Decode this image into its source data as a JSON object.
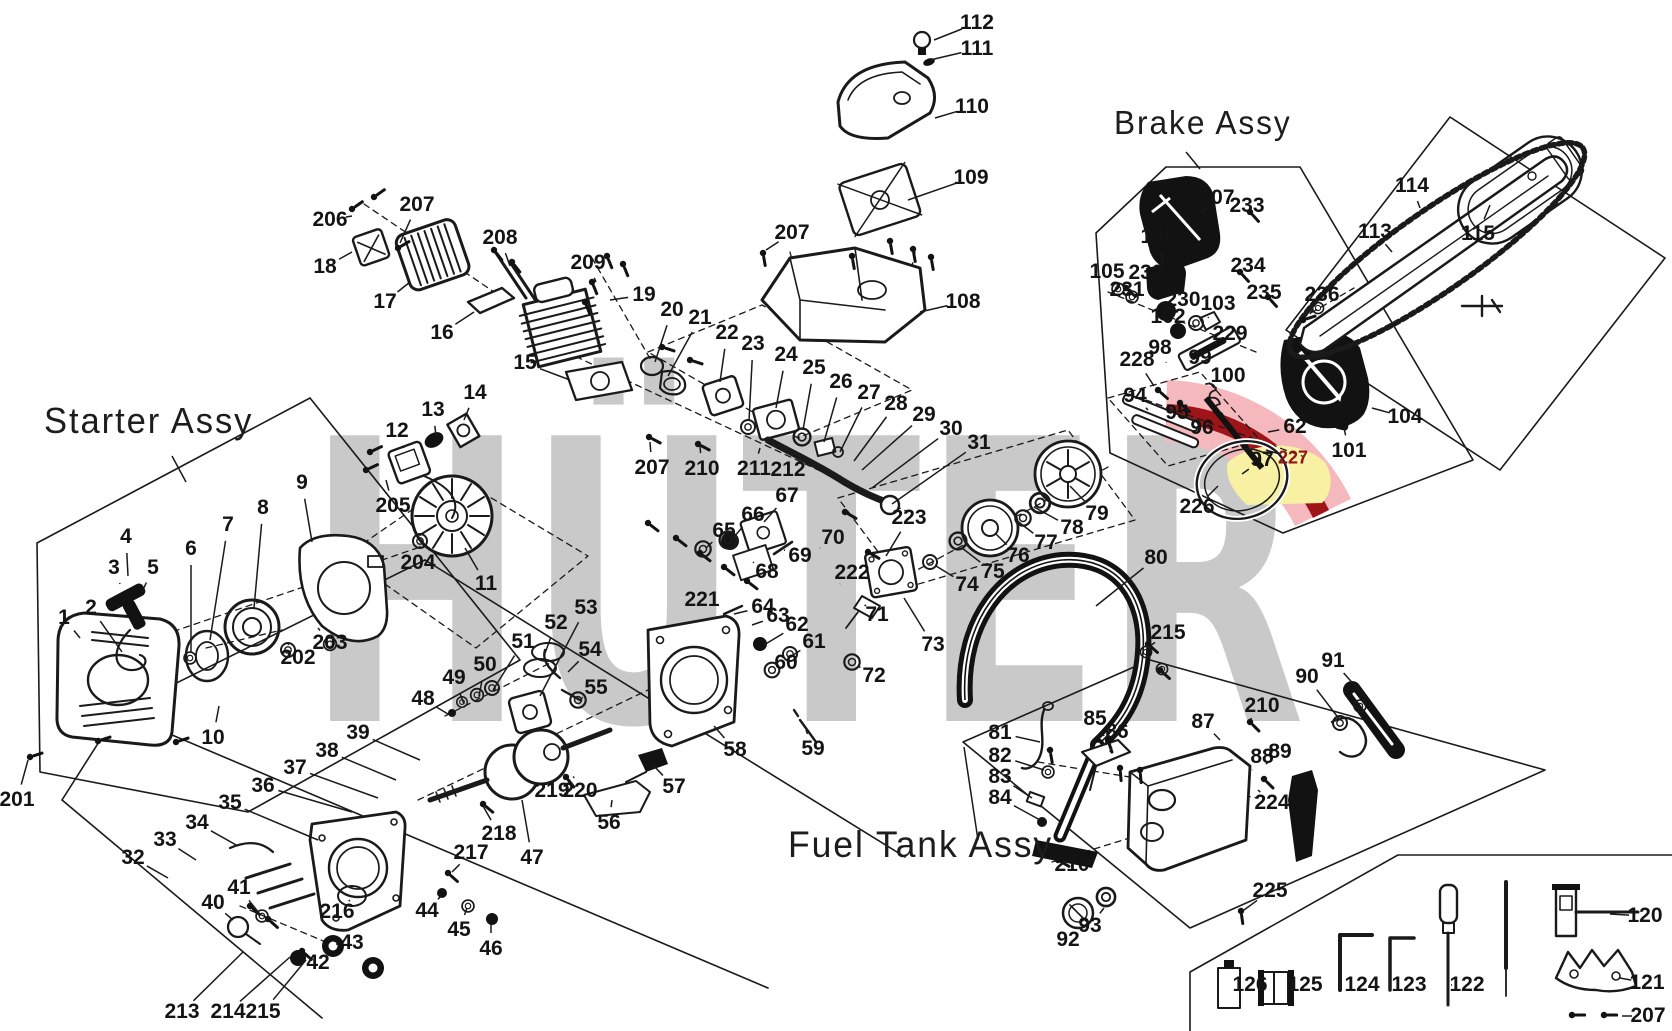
{
  "watermark": {
    "text": "HÜTER",
    "color": "#c9c9c9"
  },
  "emblem": {
    "pink": "#f5b9bd",
    "dark_red": "#9f1418",
    "yellow": "#f8f1a3"
  },
  "line_color": "#1a1a1a",
  "assemblies": [
    {
      "label": "Starter Assy",
      "x": 44,
      "y": 400,
      "size": 36,
      "leader": [
        172,
        456,
        186,
        482
      ]
    },
    {
      "label": "Brake Assy",
      "x": 1114,
      "y": 104,
      "size": 33,
      "leader": [
        1186,
        152,
        1200,
        169
      ]
    },
    {
      "label": "Fuel Tank Assy",
      "x": 788,
      "y": 824,
      "size": 37,
      "leader": [
        978,
        840,
        964,
        747
      ]
    }
  ],
  "parts": [
    {
      "n": "206",
      "x": 330,
      "y": 220,
      "t": [
        352,
        216
      ]
    },
    {
      "n": "207",
      "x": 417,
      "y": 205,
      "t": [
        400,
        243
      ]
    },
    {
      "n": "18",
      "x": 325,
      "y": 267,
      "t": [
        352,
        252
      ]
    },
    {
      "n": "17",
      "x": 385,
      "y": 302,
      "t": [
        410,
        282
      ]
    },
    {
      "n": "16",
      "x": 442,
      "y": 333,
      "t": [
        474,
        312
      ]
    },
    {
      "n": "208",
      "x": 500,
      "y": 238,
      "t": [
        510,
        266
      ]
    },
    {
      "n": "112",
      "x": 977,
      "y": 23,
      "t": [
        934,
        40
      ]
    },
    {
      "n": "111",
      "x": 977,
      "y": 49,
      "t": [
        930,
        60
      ]
    },
    {
      "n": "110",
      "x": 972,
      "y": 107,
      "t": [
        935,
        118
      ]
    },
    {
      "n": "109",
      "x": 971,
      "y": 178,
      "t": [
        908,
        200
      ]
    },
    {
      "n": "207",
      "x": 792,
      "y": 233,
      "t": [
        766,
        250
      ]
    },
    {
      "n": "108",
      "x": 963,
      "y": 302,
      "t": [
        920,
        312
      ]
    },
    {
      "n": "209",
      "x": 588,
      "y": 263,
      "t": [
        596,
        282
      ]
    },
    {
      "n": "19",
      "x": 644,
      "y": 295,
      "t": [
        610,
        300
      ]
    },
    {
      "n": "20",
      "x": 672,
      "y": 310,
      "t": [
        655,
        362
      ]
    },
    {
      "n": "21",
      "x": 700,
      "y": 318,
      "t": [
        668,
        376
      ]
    },
    {
      "n": "22",
      "x": 727,
      "y": 333,
      "t": [
        720,
        382
      ]
    },
    {
      "n": "23",
      "x": 753,
      "y": 344,
      "t": [
        749,
        421
      ]
    },
    {
      "n": "24",
      "x": 786,
      "y": 355,
      "t": [
        776,
        408
      ]
    },
    {
      "n": "25",
      "x": 814,
      "y": 368,
      "t": [
        803,
        430
      ]
    },
    {
      "n": "26",
      "x": 841,
      "y": 382,
      "t": [
        824,
        442
      ]
    },
    {
      "n": "27",
      "x": 869,
      "y": 393,
      "t": [
        840,
        452
      ]
    },
    {
      "n": "28",
      "x": 896,
      "y": 404,
      "t": [
        854,
        461
      ]
    },
    {
      "n": "29",
      "x": 924,
      "y": 415,
      "t": [
        862,
        470
      ]
    },
    {
      "n": "30",
      "x": 951,
      "y": 429,
      "t": [
        872,
        488
      ]
    },
    {
      "n": "31",
      "x": 979,
      "y": 443,
      "t": [
        892,
        504
      ]
    },
    {
      "n": "15",
      "x": 525,
      "y": 363,
      "t": [
        570,
        380
      ]
    },
    {
      "n": "207",
      "x": 652,
      "y": 468,
      "t": [
        650,
        442
      ]
    },
    {
      "n": "210",
      "x": 702,
      "y": 469,
      "t": [
        700,
        446
      ]
    },
    {
      "n": "211",
      "x": 754,
      "y": 469,
      "t": [
        760,
        448
      ]
    },
    {
      "n": "212",
      "x": 788,
      "y": 470,
      "t": [
        798,
        455
      ]
    },
    {
      "n": "1",
      "x": 64,
      "y": 618,
      "t": [
        80,
        638
      ]
    },
    {
      "n": "2",
      "x": 91,
      "y": 608,
      "t": [
        122,
        652
      ]
    },
    {
      "n": "3",
      "x": 114,
      "y": 568,
      "t": [
        120,
        584
      ]
    },
    {
      "n": "4",
      "x": 126,
      "y": 537,
      "t": [
        128,
        576
      ]
    },
    {
      "n": "5",
      "x": 153,
      "y": 568,
      "t": [
        142,
        592
      ]
    },
    {
      "n": "6",
      "x": 191,
      "y": 549,
      "t": [
        191,
        652
      ]
    },
    {
      "n": "7",
      "x": 228,
      "y": 525,
      "t": [
        210,
        640
      ]
    },
    {
      "n": "8",
      "x": 263,
      "y": 508,
      "t": [
        254,
        608
      ]
    },
    {
      "n": "9",
      "x": 302,
      "y": 483,
      "t": [
        312,
        542
      ]
    },
    {
      "n": "10",
      "x": 213,
      "y": 738,
      "t": [
        219,
        706
      ]
    },
    {
      "n": "201",
      "x": 17,
      "y": 800,
      "t": [
        28,
        760
      ]
    },
    {
      "n": "202",
      "x": 298,
      "y": 658,
      "t": [
        288,
        644
      ]
    },
    {
      "n": "203",
      "x": 330,
      "y": 643,
      "t": [
        318,
        628
      ]
    },
    {
      "n": "204",
      "x": 418,
      "y": 563,
      "t": [
        420,
        546
      ]
    },
    {
      "n": "205",
      "x": 393,
      "y": 506,
      "t": [
        386,
        480
      ]
    },
    {
      "n": "11",
      "x": 486,
      "y": 584,
      "t": [
        465,
        548
      ]
    },
    {
      "n": "12",
      "x": 397,
      "y": 431,
      "t": [
        404,
        448
      ]
    },
    {
      "n": "13",
      "x": 433,
      "y": 410,
      "t": [
        436,
        436
      ]
    },
    {
      "n": "14",
      "x": 475,
      "y": 393,
      "t": [
        464,
        420
      ]
    },
    {
      "n": "48",
      "x": 423,
      "y": 699,
      "t": [
        448,
        714
      ]
    },
    {
      "n": "49",
      "x": 454,
      "y": 678,
      "t": [
        464,
        704
      ]
    },
    {
      "n": "50",
      "x": 485,
      "y": 665,
      "t": [
        479,
        696
      ]
    },
    {
      "n": "51",
      "x": 523,
      "y": 642,
      "t": [
        493,
        690
      ]
    },
    {
      "n": "52",
      "x": 556,
      "y": 623,
      "t": [
        544,
        656
      ]
    },
    {
      "n": "53",
      "x": 586,
      "y": 608,
      "t": [
        540,
        696
      ]
    },
    {
      "n": "54",
      "x": 590,
      "y": 650,
      "t": [
        568,
        672
      ]
    },
    {
      "n": "55",
      "x": 596,
      "y": 688,
      "t": [
        582,
        698
      ]
    },
    {
      "n": "56",
      "x": 609,
      "y": 823,
      "t": [
        612,
        800
      ]
    },
    {
      "n": "57",
      "x": 674,
      "y": 787,
      "t": [
        652,
        764
      ]
    },
    {
      "n": "58",
      "x": 735,
      "y": 750,
      "t": [
        714,
        726
      ]
    },
    {
      "n": "59",
      "x": 813,
      "y": 749,
      "t": [
        806,
        730
      ]
    },
    {
      "n": "60",
      "x": 786,
      "y": 663,
      "t": [
        775,
        672
      ]
    },
    {
      "n": "61",
      "x": 814,
      "y": 642,
      "t": [
        793,
        655
      ]
    },
    {
      "n": "62",
      "x": 797,
      "y": 625,
      "t": [
        764,
        645
      ]
    },
    {
      "n": "63",
      "x": 778,
      "y": 616,
      "t": [
        752,
        625
      ]
    },
    {
      "n": "64",
      "x": 763,
      "y": 607,
      "t": [
        734,
        614
      ]
    },
    {
      "n": "65",
      "x": 724,
      "y": 531,
      "t": [
        706,
        548
      ]
    },
    {
      "n": "66",
      "x": 753,
      "y": 515,
      "t": [
        733,
        538
      ]
    },
    {
      "n": "67",
      "x": 787,
      "y": 496,
      "t": [
        764,
        522
      ]
    },
    {
      "n": "68",
      "x": 767,
      "y": 572,
      "t": [
        753,
        562
      ]
    },
    {
      "n": "69",
      "x": 800,
      "y": 556,
      "t": [
        784,
        550
      ]
    },
    {
      "n": "70",
      "x": 833,
      "y": 538,
      "t": [
        820,
        548
      ]
    },
    {
      "n": "71",
      "x": 877,
      "y": 615,
      "t": [
        866,
        606
      ]
    },
    {
      "n": "72",
      "x": 874,
      "y": 676,
      "t": [
        858,
        666
      ]
    },
    {
      "n": "221",
      "x": 702,
      "y": 600,
      "t": [
        716,
        592
      ]
    },
    {
      "n": "222",
      "x": 852,
      "y": 573,
      "t": [
        840,
        584
      ]
    },
    {
      "n": "223",
      "x": 909,
      "y": 518,
      "t": [
        886,
        556
      ]
    },
    {
      "n": "219",
      "x": 552,
      "y": 791,
      "t": [
        564,
        780
      ]
    },
    {
      "n": "220",
      "x": 580,
      "y": 791,
      "t": [
        574,
        778
      ]
    },
    {
      "n": "218",
      "x": 499,
      "y": 834,
      "t": [
        483,
        806
      ]
    },
    {
      "n": "217",
      "x": 471,
      "y": 853,
      "t": [
        452,
        872
      ]
    },
    {
      "n": "216",
      "x": 337,
      "y": 912,
      "t": [
        350,
        900
      ]
    },
    {
      "n": "47",
      "x": 532,
      "y": 858,
      "t": [
        522,
        800
      ]
    },
    {
      "n": "44",
      "x": 427,
      "y": 911,
      "t": [
        441,
        896
      ]
    },
    {
      "n": "45",
      "x": 459,
      "y": 930,
      "t": [
        467,
        908
      ]
    },
    {
      "n": "46",
      "x": 491,
      "y": 949,
      "t": [
        491,
        924
      ]
    },
    {
      "n": "43",
      "x": 352,
      "y": 943,
      "t": [
        338,
        944
      ]
    },
    {
      "n": "42",
      "x": 318,
      "y": 963,
      "t": [
        303,
        958
      ]
    },
    {
      "n": "40",
      "x": 213,
      "y": 903,
      "t": [
        233,
        920
      ]
    },
    {
      "n": "41",
      "x": 239,
      "y": 888,
      "t": [
        259,
        913
      ]
    },
    {
      "n": "32",
      "x": 133,
      "y": 858,
      "t": [
        168,
        878
      ]
    },
    {
      "n": "33",
      "x": 165,
      "y": 840,
      "t": [
        196,
        860
      ]
    },
    {
      "n": "34",
      "x": 197,
      "y": 823,
      "t": [
        238,
        846
      ]
    },
    {
      "n": "35",
      "x": 230,
      "y": 803,
      "t": [
        318,
        840
      ]
    },
    {
      "n": "36",
      "x": 263,
      "y": 786,
      "t": [
        352,
        812
      ]
    },
    {
      "n": "37",
      "x": 295,
      "y": 768,
      "t": [
        378,
        798
      ]
    },
    {
      "n": "38",
      "x": 327,
      "y": 751,
      "t": [
        396,
        780
      ]
    },
    {
      "n": "39",
      "x": 358,
      "y": 733,
      "t": [
        420,
        760
      ]
    },
    {
      "n": "213",
      "x": 182,
      "y": 1012,
      "t": [
        243,
        952
      ]
    },
    {
      "n": "214",
      "x": 228,
      "y": 1012,
      "t": [
        290,
        957
      ]
    },
    {
      "n": "215",
      "x": 263,
      "y": 1012,
      "t": [
        306,
        960
      ]
    },
    {
      "n": "73",
      "x": 933,
      "y": 645,
      "t": [
        904,
        598
      ]
    },
    {
      "n": "74",
      "x": 967,
      "y": 585,
      "t": [
        936,
        566
      ]
    },
    {
      "n": "75",
      "x": 993,
      "y": 572,
      "t": [
        962,
        548
      ]
    },
    {
      "n": "76",
      "x": 1018,
      "y": 556,
      "t": [
        996,
        534
      ]
    },
    {
      "n": "77",
      "x": 1046,
      "y": 543,
      "t": [
        1016,
        520
      ]
    },
    {
      "n": "78",
      "x": 1072,
      "y": 528,
      "t": [
        1034,
        507
      ]
    },
    {
      "n": "79",
      "x": 1097,
      "y": 514,
      "t": [
        1070,
        486
      ]
    },
    {
      "n": "80",
      "x": 1156,
      "y": 558,
      "t": [
        1096,
        606
      ]
    },
    {
      "n": "215",
      "x": 1168,
      "y": 633,
      "t": [
        1150,
        646
      ]
    },
    {
      "n": "105",
      "x": 1107,
      "y": 272,
      "t": [
        1118,
        286
      ]
    },
    {
      "n": "231",
      "x": 1127,
      "y": 290,
      "t": [
        1134,
        298
      ]
    },
    {
      "n": "232",
      "x": 1146,
      "y": 273,
      "t": [
        1152,
        292
      ]
    },
    {
      "n": "106",
      "x": 1158,
      "y": 237,
      "t": [
        1163,
        262
      ]
    },
    {
      "n": "107",
      "x": 1217,
      "y": 198,
      "t": [
        1202,
        212
      ]
    },
    {
      "n": "233",
      "x": 1247,
      "y": 206,
      "t": [
        1251,
        213
      ]
    },
    {
      "n": "230",
      "x": 1183,
      "y": 300,
      "t": [
        1171,
        308
      ]
    },
    {
      "n": "102",
      "x": 1168,
      "y": 317,
      "t": [
        1176,
        328
      ]
    },
    {
      "n": "103",
      "x": 1218,
      "y": 304,
      "t": [
        1208,
        318
      ]
    },
    {
      "n": "229",
      "x": 1230,
      "y": 334,
      "t": [
        1214,
        344
      ]
    },
    {
      "n": "234",
      "x": 1248,
      "y": 266,
      "t": [
        1242,
        274
      ]
    },
    {
      "n": "235",
      "x": 1264,
      "y": 293,
      "t": [
        1268,
        298
      ]
    },
    {
      "n": "98",
      "x": 1160,
      "y": 348,
      "t": [
        1166,
        362
      ]
    },
    {
      "n": "99",
      "x": 1200,
      "y": 358,
      "t": [
        1192,
        372
      ]
    },
    {
      "n": "100",
      "x": 1228,
      "y": 376,
      "t": [
        1216,
        388
      ]
    },
    {
      "n": "228",
      "x": 1137,
      "y": 360,
      "t": [
        1154,
        386
      ]
    },
    {
      "n": "94",
      "x": 1135,
      "y": 396,
      "t": [
        1148,
        410
      ]
    },
    {
      "n": "95",
      "x": 1177,
      "y": 413,
      "t": [
        1186,
        420
      ]
    },
    {
      "n": "96",
      "x": 1202,
      "y": 428,
      "t": [
        1212,
        434
      ]
    },
    {
      "n": "97",
      "x": 1262,
      "y": 460,
      "t": [
        1242,
        474
      ]
    },
    {
      "n": "226",
      "x": 1197,
      "y": 507,
      "t": [
        1218,
        486
      ]
    },
    {
      "n": "227",
      "x": 1293,
      "y": 458,
      "t": [
        1266,
        450
      ],
      "red": true
    },
    {
      "n": "62",
      "x": 1295,
      "y": 427,
      "t": [
        1268,
        432
      ]
    },
    {
      "n": "101",
      "x": 1349,
      "y": 451,
      "t": [
        1344,
        428
      ]
    },
    {
      "n": "104",
      "x": 1405,
      "y": 417,
      "t": [
        1372,
        408
      ]
    },
    {
      "n": "113",
      "x": 1375,
      "y": 232,
      "t": [
        1392,
        252
      ]
    },
    {
      "n": "114",
      "x": 1412,
      "y": 186,
      "t": [
        1420,
        208
      ]
    },
    {
      "n": "115",
      "x": 1478,
      "y": 234,
      "t": [
        1490,
        205
      ]
    },
    {
      "n": "236",
      "x": 1322,
      "y": 295,
      "t": [
        1310,
        314
      ]
    },
    {
      "n": "81",
      "x": 1000,
      "y": 733,
      "t": [
        1040,
        742
      ]
    },
    {
      "n": "82",
      "x": 1000,
      "y": 756,
      "t": [
        1044,
        770
      ]
    },
    {
      "n": "83",
      "x": 1000,
      "y": 777,
      "t": [
        1032,
        798
      ]
    },
    {
      "n": "84",
      "x": 1000,
      "y": 798,
      "t": [
        1040,
        820
      ]
    },
    {
      "n": "85",
      "x": 1095,
      "y": 719,
      "t": [
        1104,
        736
      ]
    },
    {
      "n": "86",
      "x": 1117,
      "y": 732,
      "t": [
        1110,
        752
      ]
    },
    {
      "n": "87",
      "x": 1203,
      "y": 722,
      "t": [
        1220,
        740
      ]
    },
    {
      "n": "88",
      "x": 1262,
      "y": 757,
      "t": [
        1252,
        770
      ]
    },
    {
      "n": "89",
      "x": 1280,
      "y": 752,
      "t": [
        1266,
        764
      ]
    },
    {
      "n": "224",
      "x": 1272,
      "y": 803,
      "t": [
        1258,
        790
      ]
    },
    {
      "n": "210",
      "x": 1262,
      "y": 706,
      "t": [
        1250,
        720
      ]
    },
    {
      "n": "90",
      "x": 1307,
      "y": 677,
      "t": [
        1340,
        720
      ]
    },
    {
      "n": "91",
      "x": 1333,
      "y": 661,
      "t": [
        1366,
        698
      ]
    },
    {
      "n": "92",
      "x": 1068,
      "y": 940,
      "t": [
        1076,
        928
      ]
    },
    {
      "n": "93",
      "x": 1090,
      "y": 926,
      "t": [
        1104,
        908
      ]
    },
    {
      "n": "225",
      "x": 1270,
      "y": 891,
      "t": [
        1244,
        910
      ]
    },
    {
      "n": "210",
      "x": 1072,
      "y": 865,
      "t": [
        1060,
        862
      ]
    },
    {
      "n": "126",
      "x": 1250,
      "y": 985,
      "t": [
        1240,
        985
      ]
    },
    {
      "n": "125",
      "x": 1305,
      "y": 985,
      "t": [
        1292,
        985
      ]
    },
    {
      "n": "124",
      "x": 1362,
      "y": 985,
      "t": [
        1348,
        985
      ]
    },
    {
      "n": "123",
      "x": 1409,
      "y": 985,
      "t": [
        1396,
        985
      ]
    },
    {
      "n": "122",
      "x": 1467,
      "y": 985,
      "t": [
        1452,
        985
      ]
    },
    {
      "n": "120",
      "x": 1645,
      "y": 916,
      "t": [
        1610,
        914
      ]
    },
    {
      "n": "121",
      "x": 1647,
      "y": 983,
      "t": [
        1620,
        978
      ]
    },
    {
      "n": "207",
      "x": 1648,
      "y": 1016,
      "t": [
        1622,
        1016
      ]
    }
  ]
}
